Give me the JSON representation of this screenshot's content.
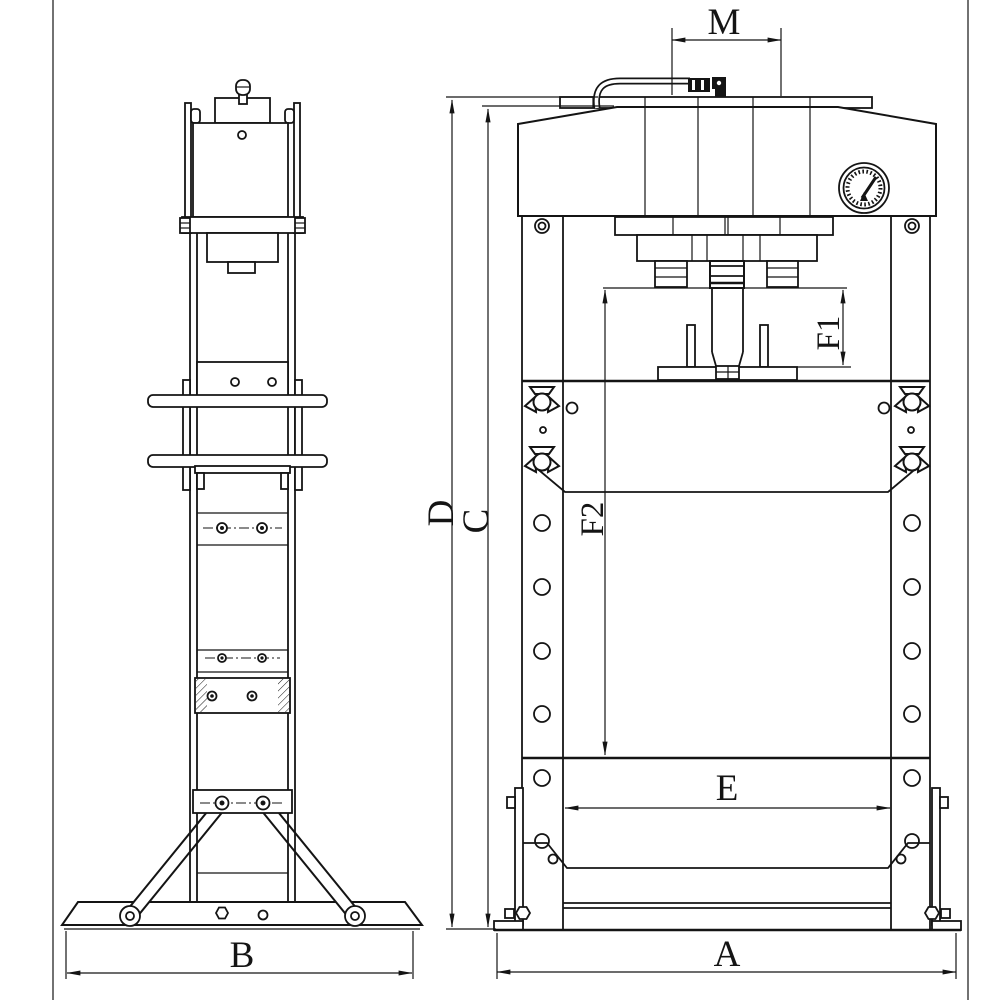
{
  "document": {
    "kind": "engineering-drawing",
    "background_color": "#ffffff",
    "line_color": "#141414"
  },
  "labels": {
    "m": "M",
    "d": "D",
    "c": "C",
    "f1": "F1",
    "f2": "F2",
    "e": "E",
    "a": "A",
    "b": "B"
  }
}
